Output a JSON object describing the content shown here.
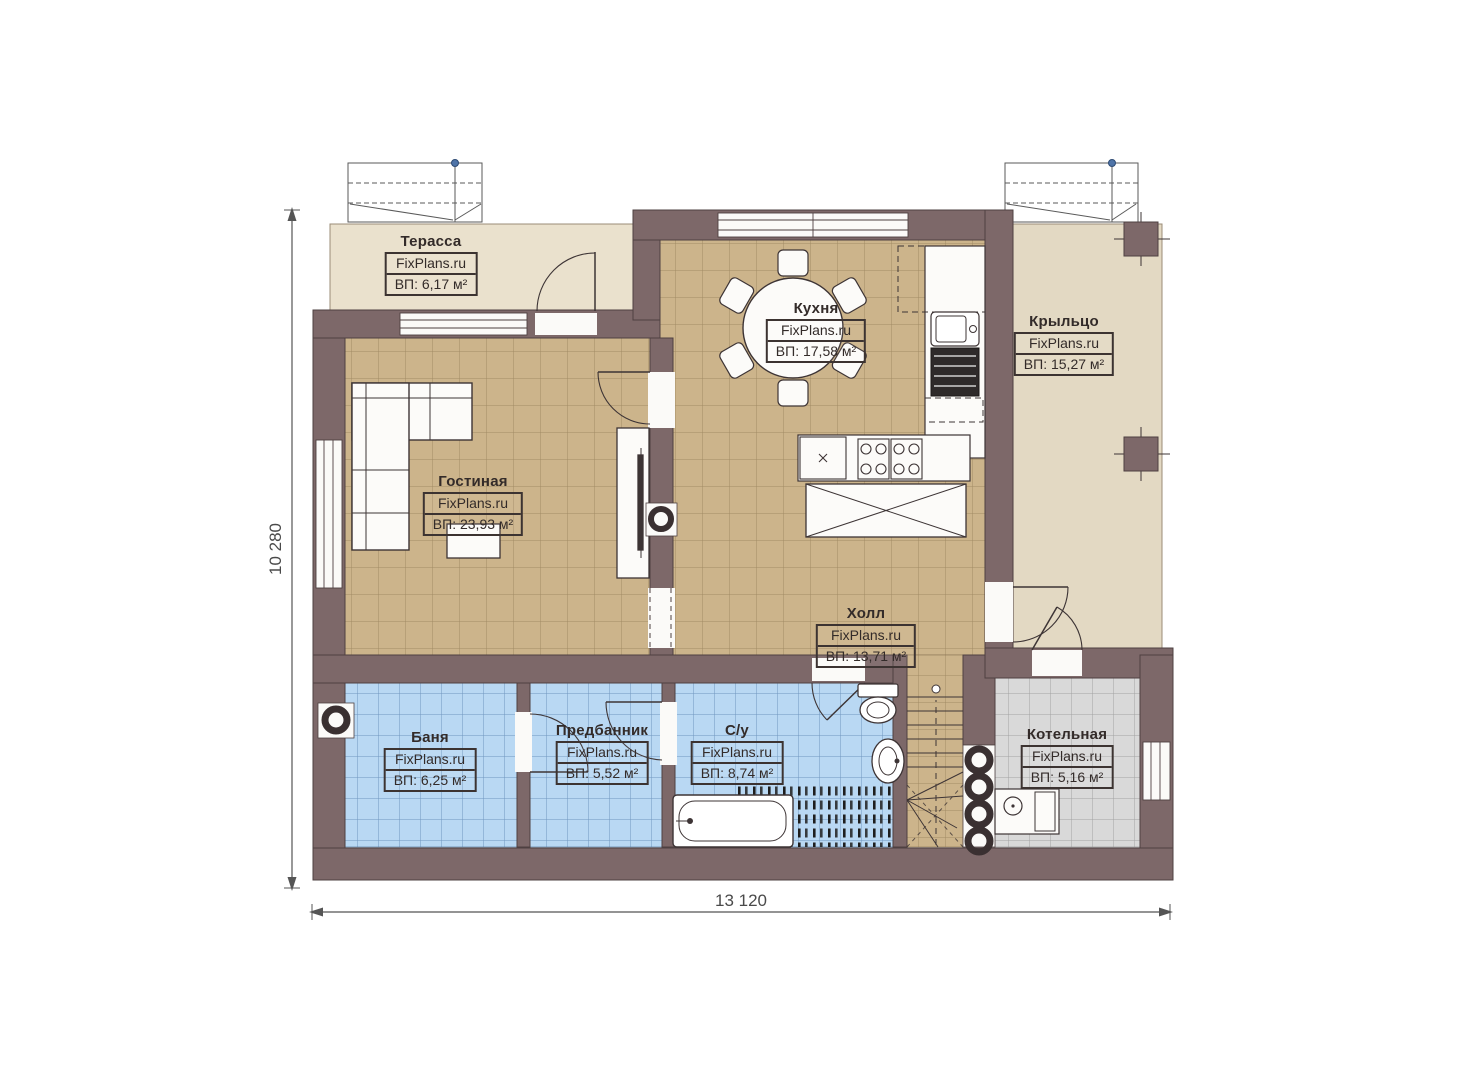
{
  "brand": "FixPlans.ru",
  "dimensions": {
    "vertical": "10 280",
    "horizontal": "13 120"
  },
  "rooms": [
    {
      "id": "terrace",
      "name": "Терасса",
      "brand": "FixPlans.ru",
      "area": "ВП: 6,17 м²"
    },
    {
      "id": "kitchen",
      "name": "Кухня",
      "brand": "FixPlans.ru",
      "area": "ВП: 17,58 м²"
    },
    {
      "id": "porch",
      "name": "Крыльцо",
      "brand": "FixPlans.ru",
      "area": "ВП: 15,27 м²"
    },
    {
      "id": "living",
      "name": "Гостиная",
      "brand": "FixPlans.ru",
      "area": "ВП: 23,93 м²"
    },
    {
      "id": "hall",
      "name": "Холл",
      "brand": "FixPlans.ru",
      "area": "ВП: 13,71 м²"
    },
    {
      "id": "banya",
      "name": "Баня",
      "brand": "FixPlans.ru",
      "area": "ВП: 6,25 м²"
    },
    {
      "id": "predbannik",
      "name": "Предбанник",
      "brand": "FixPlans.ru",
      "area": "ВП: 5,52 м²"
    },
    {
      "id": "su",
      "name": "С/у",
      "brand": "FixPlans.ru",
      "area": "ВП: 8,74 м²"
    },
    {
      "id": "boiler",
      "name": "Котельная",
      "brand": "FixPlans.ru",
      "area": "ВП: 5,16 м²"
    }
  ],
  "colors": {
    "wall": "#7d6869",
    "wall_outline": "#4e4041",
    "floor_tan": "#ccb48b",
    "floor_blue": "#b9d8f3",
    "floor_gray": "#d9d9d9",
    "terrace_deck": "#eae1cd",
    "porch_deck": "#e3d9c3",
    "dimension_text": "#4a4a4a"
  }
}
